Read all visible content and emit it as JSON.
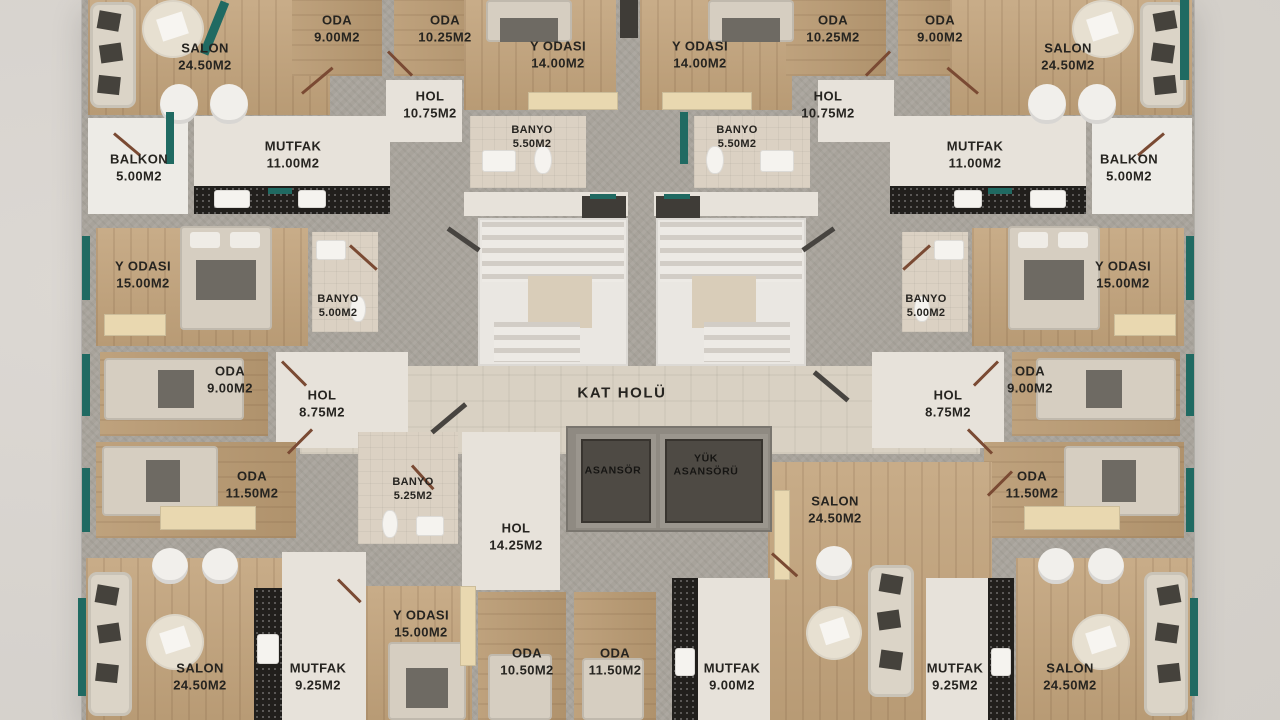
{
  "plan": {
    "type": "apartment-floor-plan",
    "central_hall": "KAT HOLÜ"
  },
  "colors": {
    "background": "#d6d2cd",
    "wall": "#a8a39b",
    "wood_floor": "#c2a37b",
    "tile_floor": "#e7e2da",
    "bath_floor": "#dbd1c3",
    "hall_floor": "#d9d1c3",
    "balcony_floor": "#edebe6",
    "accent_teal": "#206a62",
    "kitchen_counter": "#211f1c",
    "elevator_cab": "#4e4a44",
    "door_swing": "#7a4a33",
    "label_text": "#262420"
  },
  "rooms": [
    {
      "name": "SALON",
      "area": "24.50M2"
    },
    {
      "name": "ODA",
      "area": "9.00M2"
    },
    {
      "name": "ODA",
      "area": "10.25M2"
    },
    {
      "name": "Y ODASI",
      "area": "14.00M2"
    },
    {
      "name": "Y ODASI",
      "area": "14.00M2"
    },
    {
      "name": "ODA",
      "area": "10.25M2"
    },
    {
      "name": "ODA",
      "area": "9.00M2"
    },
    {
      "name": "SALON",
      "area": "24.50M2"
    },
    {
      "name": "HOL",
      "area": "10.75M2"
    },
    {
      "name": "HOL",
      "area": "10.75M2"
    },
    {
      "name": "BANYO",
      "area": "5.50M2"
    },
    {
      "name": "BANYO",
      "area": "5.50M2"
    },
    {
      "name": "MUTFAK",
      "area": "11.00M2"
    },
    {
      "name": "MUTFAK",
      "area": "11.00M2"
    },
    {
      "name": "BALKON",
      "area": "5.00M2"
    },
    {
      "name": "BALKON",
      "area": "5.00M2"
    },
    {
      "name": "Y ODASI",
      "area": "15.00M2"
    },
    {
      "name": "Y ODASI",
      "area": "15.00M2"
    },
    {
      "name": "BANYO",
      "area": "5.00M2"
    },
    {
      "name": "BANYO",
      "area": "5.00M2"
    },
    {
      "name": "ODA",
      "area": "9.00M2"
    },
    {
      "name": "ODA",
      "area": "9.00M2"
    },
    {
      "name": "HOL",
      "area": "8.75M2"
    },
    {
      "name": "HOL",
      "area": "8.75M2"
    },
    {
      "name": "KAT HOLÜ",
      "area": ""
    },
    {
      "name": "ODA",
      "area": "11.50M2"
    },
    {
      "name": "ODA",
      "area": "11.50M2"
    },
    {
      "name": "BANYO",
      "area": "5.25M2"
    },
    {
      "name": "HOL",
      "area": "14.25M2"
    },
    {
      "name": "ASANSÖR",
      "area": ""
    },
    {
      "name": "YÜK",
      "area": "ASANSÖRÜ"
    },
    {
      "name": "SALON",
      "area": "24.50M2"
    },
    {
      "name": "SALON",
      "area": "24.50M2"
    },
    {
      "name": "MUTFAK",
      "area": "9.25M2"
    },
    {
      "name": "Y ODASI",
      "area": "15.00M2"
    },
    {
      "name": "ODA",
      "area": "10.50M2"
    },
    {
      "name": "ODA",
      "area": "11.50M2"
    },
    {
      "name": "MUTFAK",
      "area": "9.00M2"
    },
    {
      "name": "MUTFAK",
      "area": "9.25M2"
    },
    {
      "name": "SALON",
      "area": "24.50M2"
    }
  ]
}
